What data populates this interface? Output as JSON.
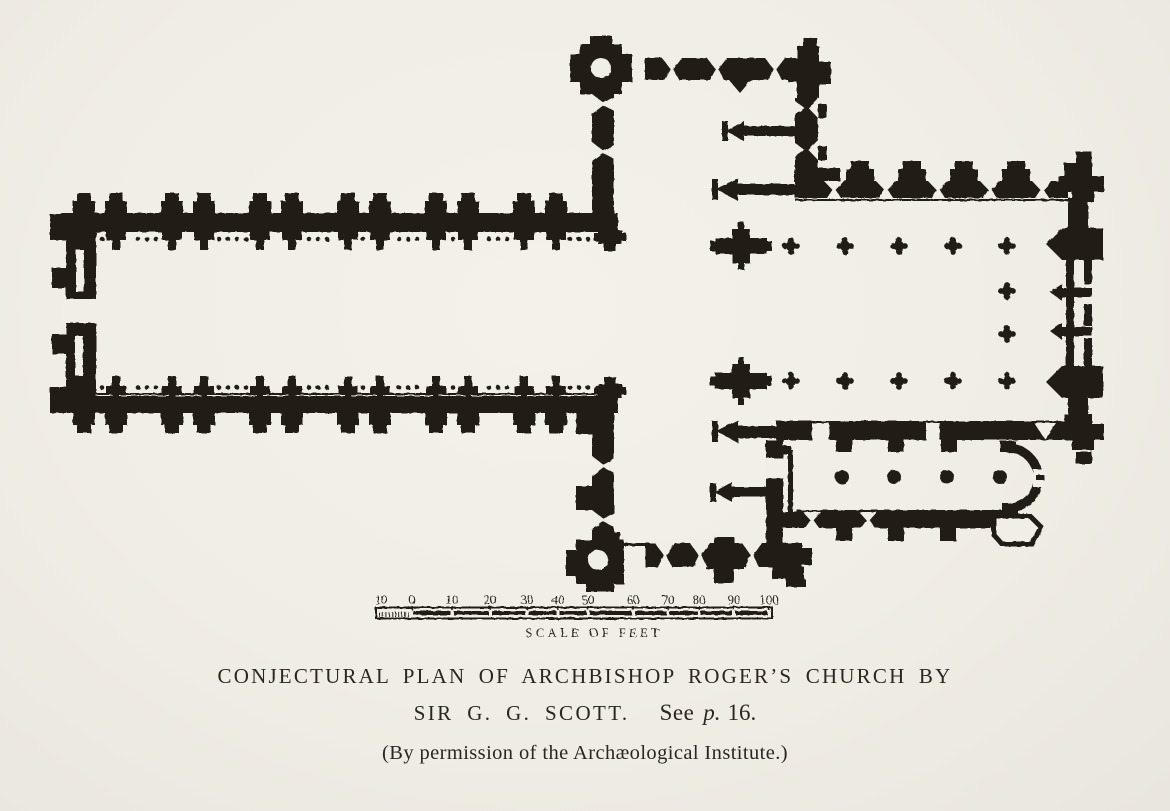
{
  "page": {
    "paper_color": "#f1eee7",
    "ink_color": "#221e18"
  },
  "scale_bar": {
    "labels": [
      "10",
      "0",
      "10",
      "20",
      "30",
      "40",
      "50",
      "60",
      "70",
      "80",
      "90",
      "100"
    ],
    "title": "SCALE OF FEET"
  },
  "caption": {
    "line1": "CONJECTURAL PLAN OF ARCHBISHOP ROGER’S CHURCH BY",
    "line2_name": "SIR G. G. SCOTT.",
    "line2_see": "See",
    "line2_page_abbrev": "p.",
    "line2_page_number": "16.",
    "line3": "(By permission of the Archæological Institute.)"
  }
}
